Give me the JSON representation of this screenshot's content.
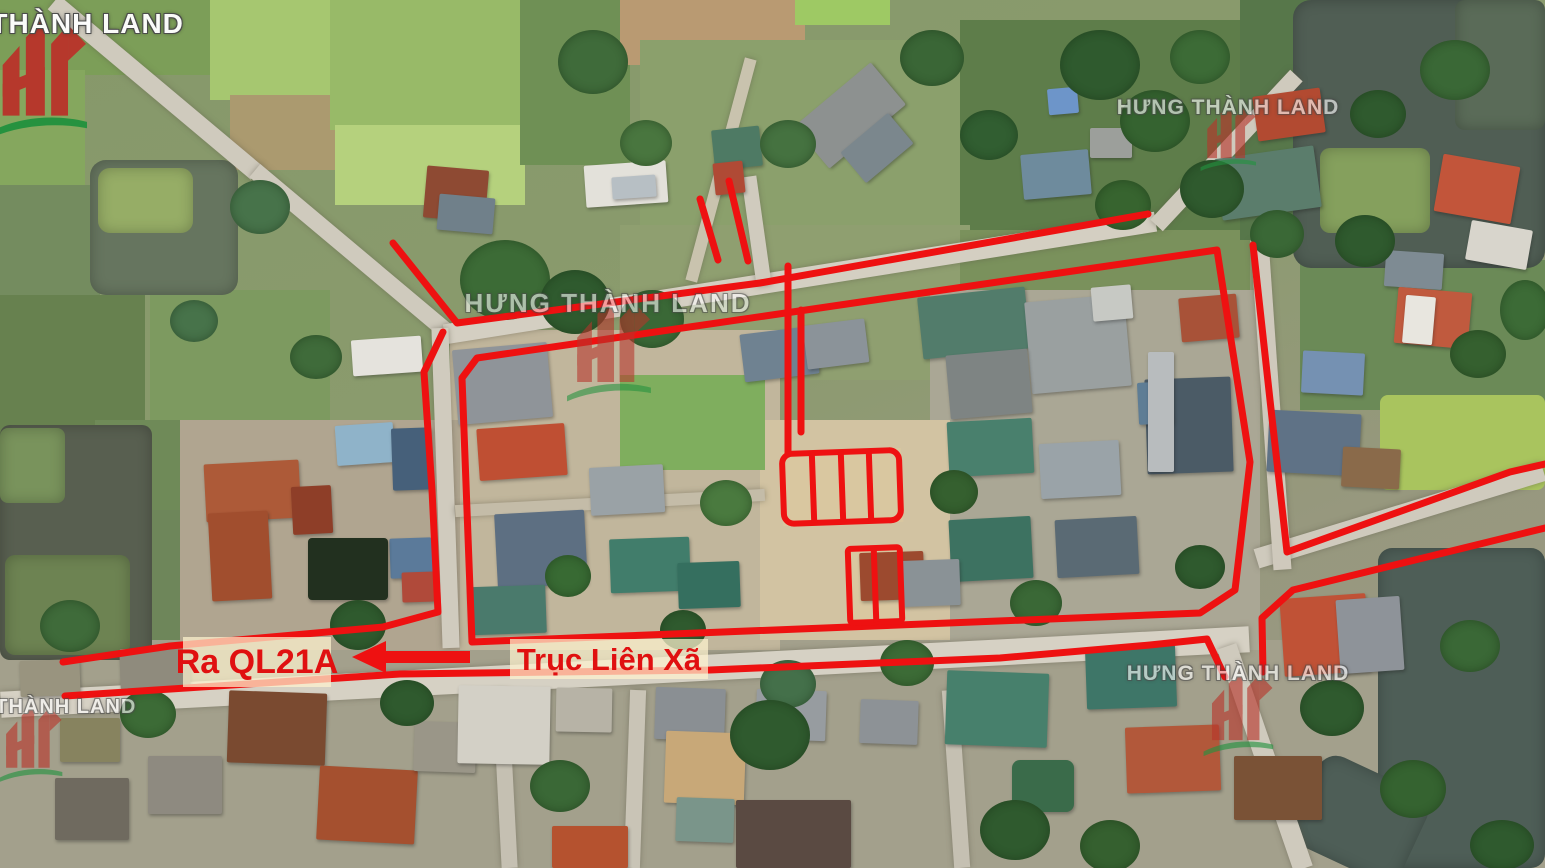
{
  "map": {
    "type": "aerial-real-estate-annotation-map",
    "direction_label": "Ra QL21A",
    "road_axis_label": "Trục Liên Xã",
    "annotation_color": "#ee1111",
    "label_text_color": "#e01010",
    "label_bg_color": "rgba(253,243,206,0.72)",
    "arrow_direction": "left",
    "plot_groups": [
      {
        "name": "upper-plot-group",
        "subdivisions": 4
      },
      {
        "name": "lower-plot-group",
        "subdivisions": 2
      }
    ]
  },
  "watermark": {
    "brand": "HƯNG THÀNH LAND",
    "logo_red": "#b8352b",
    "logo_green": "#23923f",
    "positions": [
      "top-left",
      "top-right",
      "center",
      "bottom-left",
      "bottom-right"
    ]
  }
}
